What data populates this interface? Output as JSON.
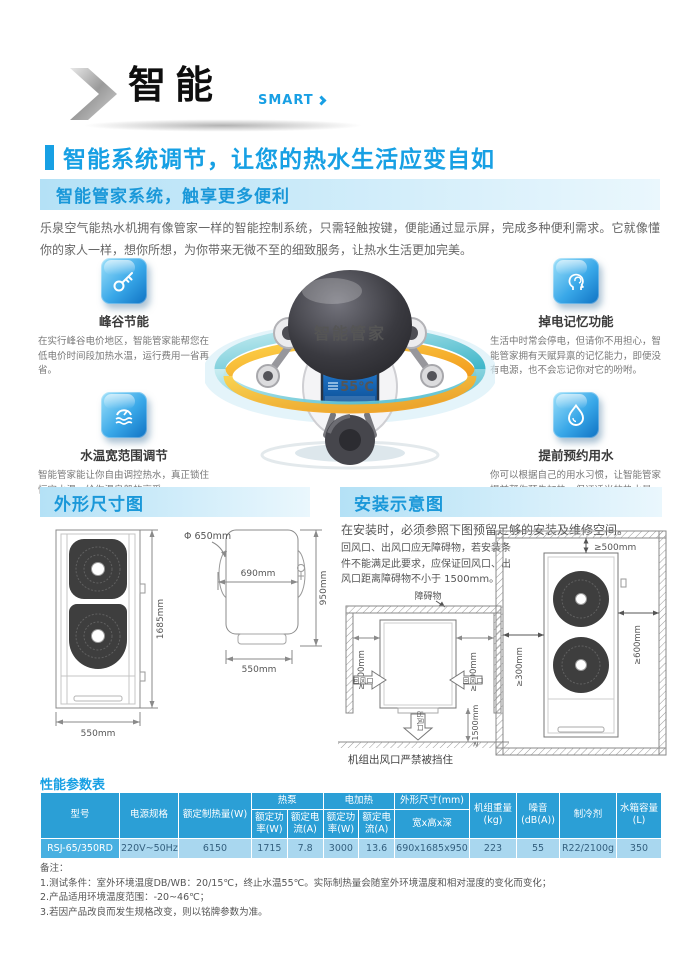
{
  "header": {
    "title": "智能",
    "subtitle": "SMART"
  },
  "main_heading": "智能系统调节，让您的热水生活应变自如",
  "intro": {
    "title": "智能管家系统，触享更多便利",
    "body": "乐泉空气能热水机拥有像管家一样的智能控制系统，只需轻触按键，便能通过显示屏，完成多种便利需求。它就像懂你的家人一样，想你所想，为你带来无微不至的细致服务，让热水生活更加完美。"
  },
  "robot": {
    "head_label": "智能管家",
    "screen_temp": "55℃"
  },
  "features": [
    {
      "icon": "key-icon",
      "title": "峰谷节能",
      "desc": "在实行峰谷电价地区，智能管家能帮您在低电价时间段加热水温，运行费用一省再省。"
    },
    {
      "icon": "memory-icon",
      "title": "掉电记忆功能",
      "desc": "生活中时常会停电，但请你不用担心，智能管家拥有天赋异禀的记忆能力，即便没有电源，也不会忘记你对它的吩咐。"
    },
    {
      "icon": "temp-range-icon",
      "title": "水温宽范围调节",
      "desc": "智能管家能让你自由调控热水，真正锁住恒定水温，给你温泉般的享受。"
    },
    {
      "icon": "water-droplet-icon",
      "title": "提前预约用水",
      "desc": "你可以根据自己的用水习惯，让智能管家提前帮你预先加热，保证适当的热水量。"
    }
  ],
  "dimensions": {
    "title": "外形尺寸图",
    "front": {
      "height": "1685mm",
      "width": "550mm"
    },
    "top": {
      "diameter": "Φ 650mm",
      "width": "690mm",
      "depth": "950mm",
      "base_width": "550mm"
    }
  },
  "installation": {
    "title": "安装示意图",
    "intro": "在安装时，必须参照下图预留足够的安装及维修空间。",
    "note": "回风口、出风口应无障碍物，若安装条件不能满足此要求，应保证回风口、出风口距离障碍物不小于 1500mm。",
    "obstacle": "障碍物",
    "left_clearance": "≥300mm",
    "right_clearance": "≥600mm",
    "top_clearance": "≥500mm",
    "bottom_clearance": "≥1500mm",
    "air_inlet": "回风口",
    "air_outlet": "出风口",
    "caution": "机组出风口严禁被挡住"
  },
  "spec_table": {
    "title": "性能参数表",
    "headers": {
      "model": "型号",
      "power_supply": "电源规格",
      "rated_heating": "额定制热量(W)",
      "heat_pump": "热泵",
      "electric_heating": "电加热",
      "rated_power": "额定功率(W)",
      "rated_current": "额定电流(A)",
      "dimensions": "外形尺寸(mm)",
      "dimensions_sub": "宽x高x深",
      "weight": "机组重量 (kg)",
      "noise": "噪音 (dB(A))",
      "refrigerant": "制冷剂",
      "tank": "水箱容量 (L)"
    },
    "row": {
      "model": "RSJ-65/350RD",
      "power_supply": "220V~50Hz",
      "rated_heating": "6150",
      "hp_power": "1715",
      "hp_current": "7.8",
      "eh_power": "3000",
      "eh_current": "13.6",
      "dims": "690x1685x950",
      "weight": "223",
      "noise": "55",
      "refrigerant": "R22/2100g",
      "tank": "350"
    }
  },
  "notes": {
    "label": "备注：",
    "items": [
      "1.测试条件：室外环境温度DB/WB：20/15℃，终止水温55℃。实际制热量会随室外环境温度和相对湿度的变化而变化；",
      "2.产品适用环境温度范围：-20~46℃；",
      "3.若因产品改良而发生规格改变，则以铭牌参数为准。"
    ]
  },
  "colors": {
    "accent_blue": "#17a0e4",
    "band_blue": "#b4e1f6",
    "table_header_blue": "#2b9fd6",
    "table_row_blue": "#a9d7ef",
    "model_cell_blue": "#48b0e1",
    "ring_teal": "#3fb6c9",
    "ring_orange": "#f29b1d"
  }
}
